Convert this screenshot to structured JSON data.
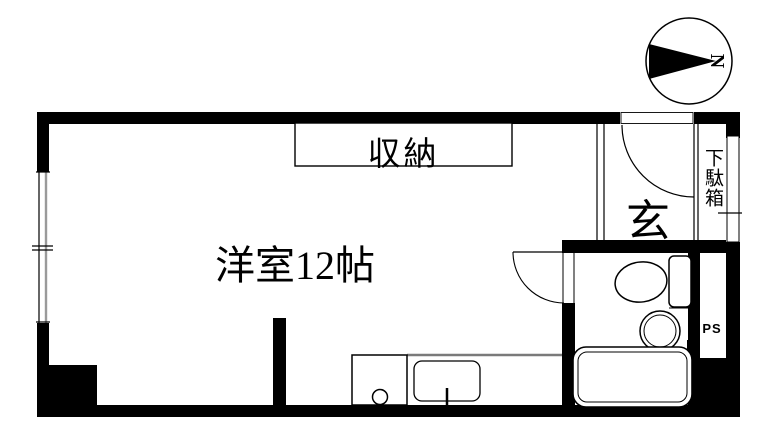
{
  "compass": {
    "north_label": "N"
  },
  "labels": {
    "main_room": "洋室12帖",
    "closet": "収納",
    "entrance": "玄",
    "shoe_cabinet": "下駄箱",
    "pipe_space": "PS"
  },
  "colors": {
    "wall": "#000000",
    "background": "#ffffff",
    "counter_edge": "#7a7a7a",
    "window_shade": "#9a9a9a"
  }
}
